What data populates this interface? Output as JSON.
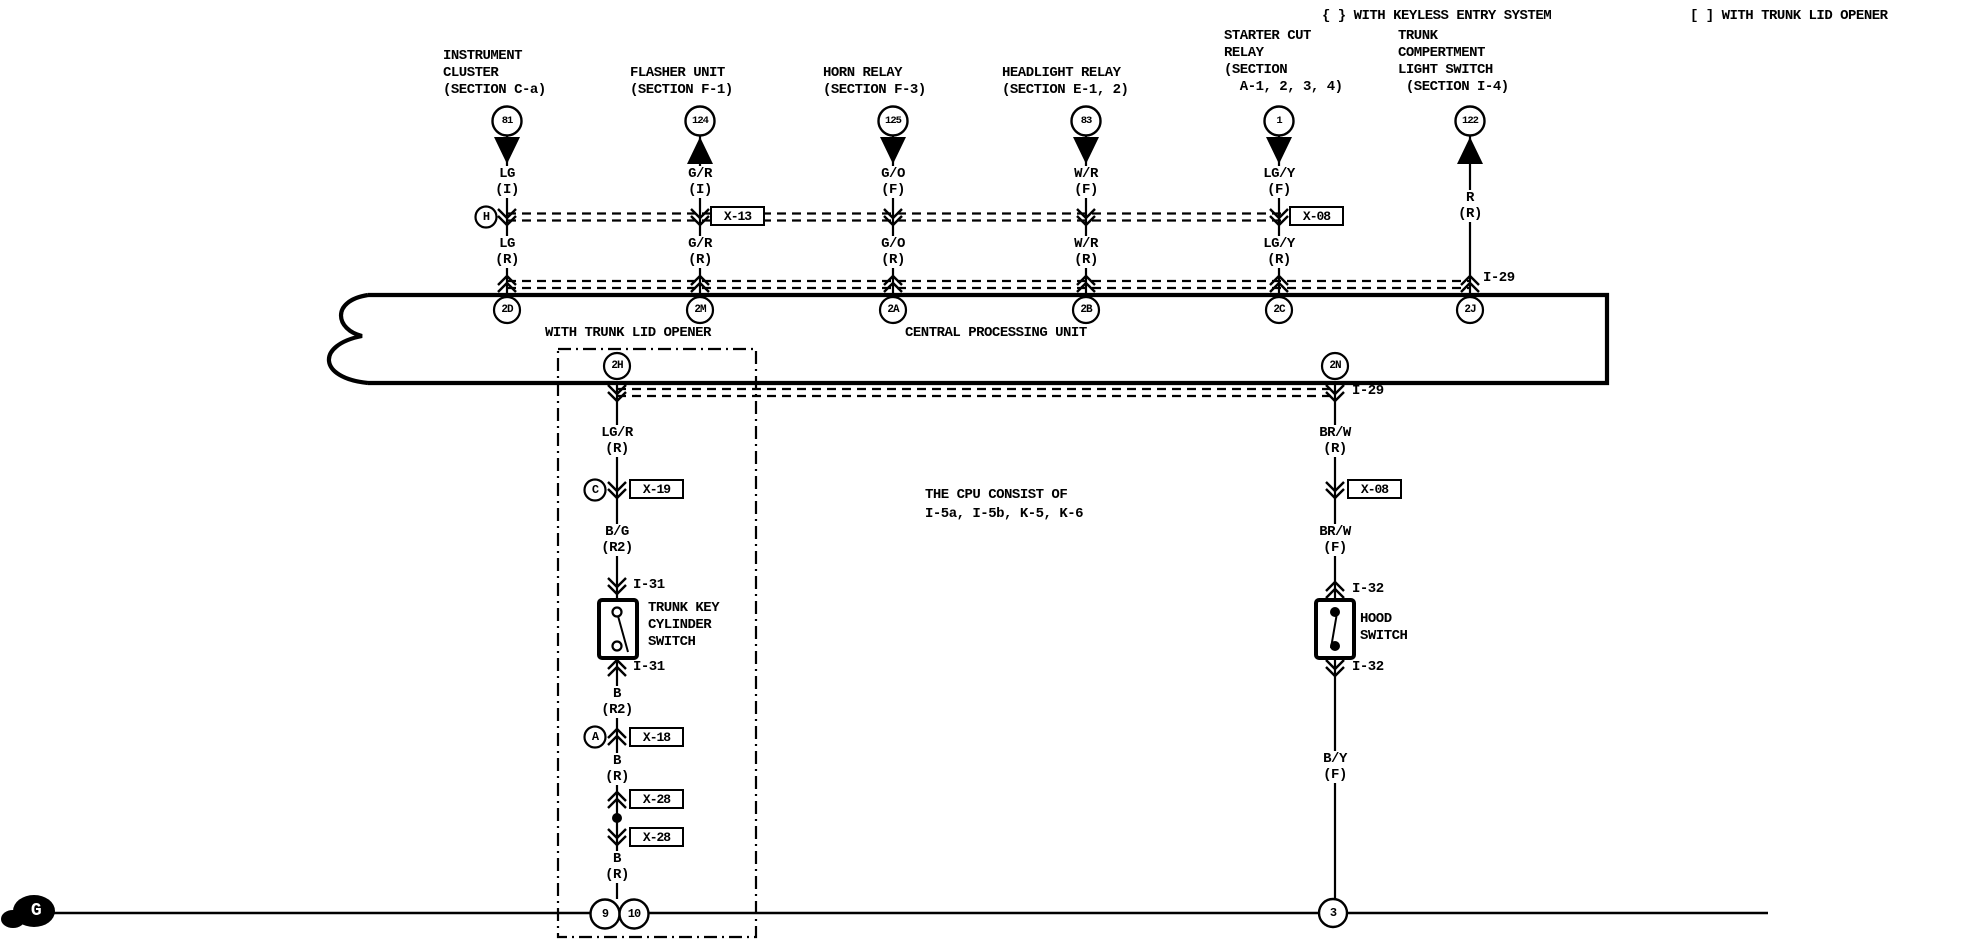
{
  "legend": {
    "keyless": "{ } WITH KEYLESS ENTRY SYSTEM",
    "trunk_lid": "[ ] WITH TRUNK LID OPENER"
  },
  "cpu": {
    "title": "CENTRAL PROCESSING UNIT",
    "option_label": "WITH TRUNK LID OPENER",
    "note": "THE CPU CONSIST OF\nI-5a, I-5b, K-5, K-6",
    "top_pins": [
      "2D",
      "2M",
      "2A",
      "2B",
      "2C",
      "2J"
    ],
    "bottom_pins": [
      "2H",
      "2N"
    ],
    "bus_label_top": "I-29",
    "bus_label_bottom": "I-29"
  },
  "components": [
    {
      "label": "INSTRUMENT\nCLUSTER\n(SECTION C-a)",
      "ref": "81",
      "arrow": "down",
      "wire_upper": "LG\n(I)",
      "wire_lower": "LG\n(R)",
      "connector_letter": "H",
      "pin": "2D"
    },
    {
      "label": "FLASHER UNIT\n(SECTION F-1)",
      "ref": "124",
      "arrow": "up",
      "wire_upper": "G/R\n(I)",
      "wire_lower": "G/R\n(R)",
      "connector": "X-13",
      "pin": "2M"
    },
    {
      "label": "HORN RELAY\n(SECTION F-3)",
      "ref": "125",
      "arrow": "down",
      "wire_upper": "G/O\n(F)",
      "wire_lower": "G/O\n(R)",
      "pin": "2A"
    },
    {
      "label": "HEADLIGHT RELAY\n(SECTION E-1, 2)",
      "ref": "83",
      "arrow": "down",
      "wire_upper": "W/R\n(F)",
      "wire_lower": "W/R\n(R)",
      "pin": "2B"
    },
    {
      "label": "STARTER CUT\nRELAY\n(SECTION\n  A-1, 2, 3, 4)",
      "ref": "1",
      "arrow": "down",
      "wire_upper": "LG/Y\n(F)",
      "wire_lower": "LG/Y\n(R)",
      "connector": "X-08",
      "pin": "2C"
    },
    {
      "label": "TRUNK\nCOMPERTMENT\nLIGHT SWITCH\n (SECTION I-4)",
      "ref": "122",
      "arrow": "up",
      "wire": "R\n(R)",
      "pin": "2J"
    }
  ],
  "trunk_branch": {
    "option_pin": "2H",
    "wire1": "LG/R\n(R)",
    "conn1_letter": "C",
    "conn1": "X-19",
    "wire2": "B/G\n(R2)",
    "conn2": "I-31",
    "switch_label": "TRUNK KEY\nCYLINDER\nSWITCH",
    "conn3": "I-31",
    "wire3": "B\n(R2)",
    "conn4_letter": "A",
    "conn4": "X-18",
    "wire4": "B\n(R)",
    "conn5": "X-28",
    "conn6": "X-28",
    "wire5": "B\n(R)",
    "ground_pin_a": "9",
    "ground_pin_b": "10"
  },
  "hood_branch": {
    "option_pin": "2N",
    "bus_label": "I-29",
    "wire1": "BR/W\n(R)",
    "conn1": "X-08",
    "wire2": "BR/W\n(F)",
    "conn2": "I-32",
    "switch_label": "HOOD\nSWITCH",
    "conn3": "I-32",
    "wire3": "B/Y\n(F)",
    "ground_pin": "3"
  },
  "ground": {
    "label": "G"
  },
  "colors": {
    "ink": "#000000",
    "paper": "#ffffff"
  }
}
